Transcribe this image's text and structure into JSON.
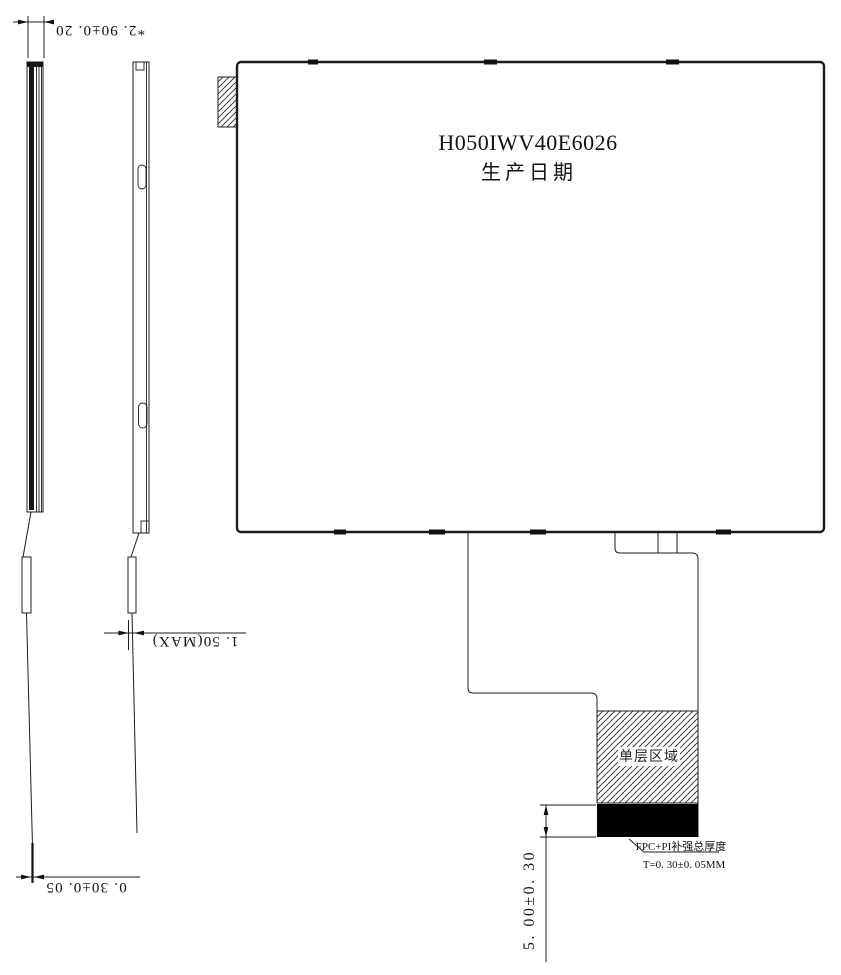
{
  "drawing": {
    "background_color": "#ffffff",
    "line_color": "#1c1c1c",
    "main_view": {
      "part_number": "H050IWV40E6026",
      "production_date_label": "生产日期"
    },
    "fpc": {
      "single_layer_region_label": "单层区域",
      "stiffener_note_line1": "FPC+PI补强总厚度",
      "stiffener_note_line2": "T=0. 30±0. 05MM"
    },
    "dimensions": {
      "module_total_thickness": "*2. 90±0. 20",
      "fpc_fold_max_thickness": "1. 50(MAX)",
      "fpc_thickness": "0. 30±0. 05",
      "fpc_tail_length": "5. 00±0. 30"
    }
  }
}
